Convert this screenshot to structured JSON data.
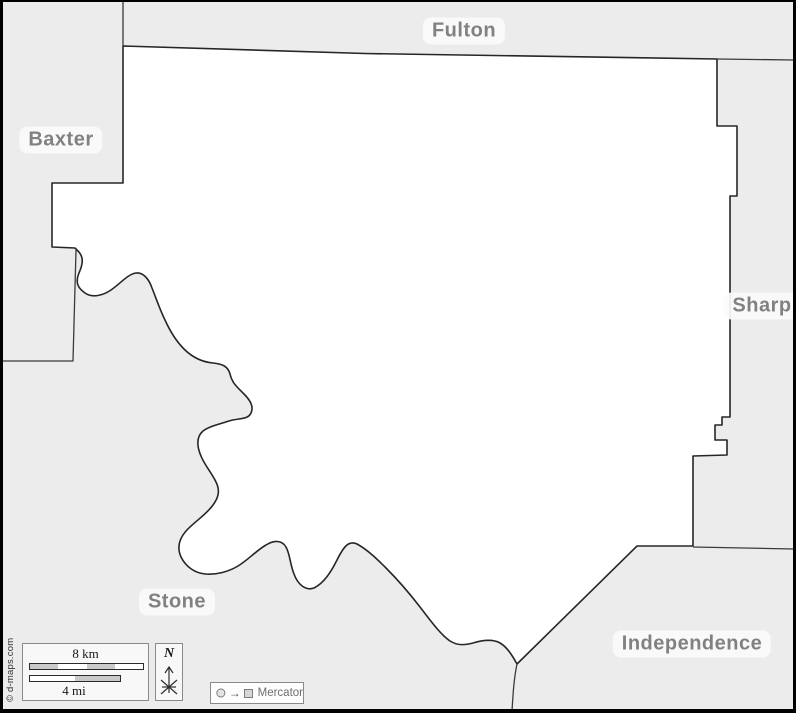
{
  "regions": {
    "county_labels": [
      {
        "id": "fulton",
        "label": "Fulton"
      },
      {
        "id": "baxter",
        "label": "Baxter"
      },
      {
        "id": "sharp",
        "label": "Sharp"
      },
      {
        "id": "stone",
        "label": "Stone"
      },
      {
        "id": "independence",
        "label": "Independence"
      }
    ]
  },
  "legend": {
    "scale_km_label": "8 km",
    "scale_mi_label": "4 mi",
    "north_label": "N",
    "projection_label": "Mercator"
  },
  "copyright": "© d-maps.com",
  "colors": {
    "map-bg": "#ececec",
    "county-fill": "#ffffff",
    "boundary": "#262626",
    "neighbor-line": "#3a3a3a",
    "label-text": "#787878",
    "label-plate": "#fbfbfb",
    "scale-segment": "#c9c9c9",
    "box-border": "#8a8a8a",
    "box-fill": "#f8f8f8",
    "frame": "#000000"
  }
}
